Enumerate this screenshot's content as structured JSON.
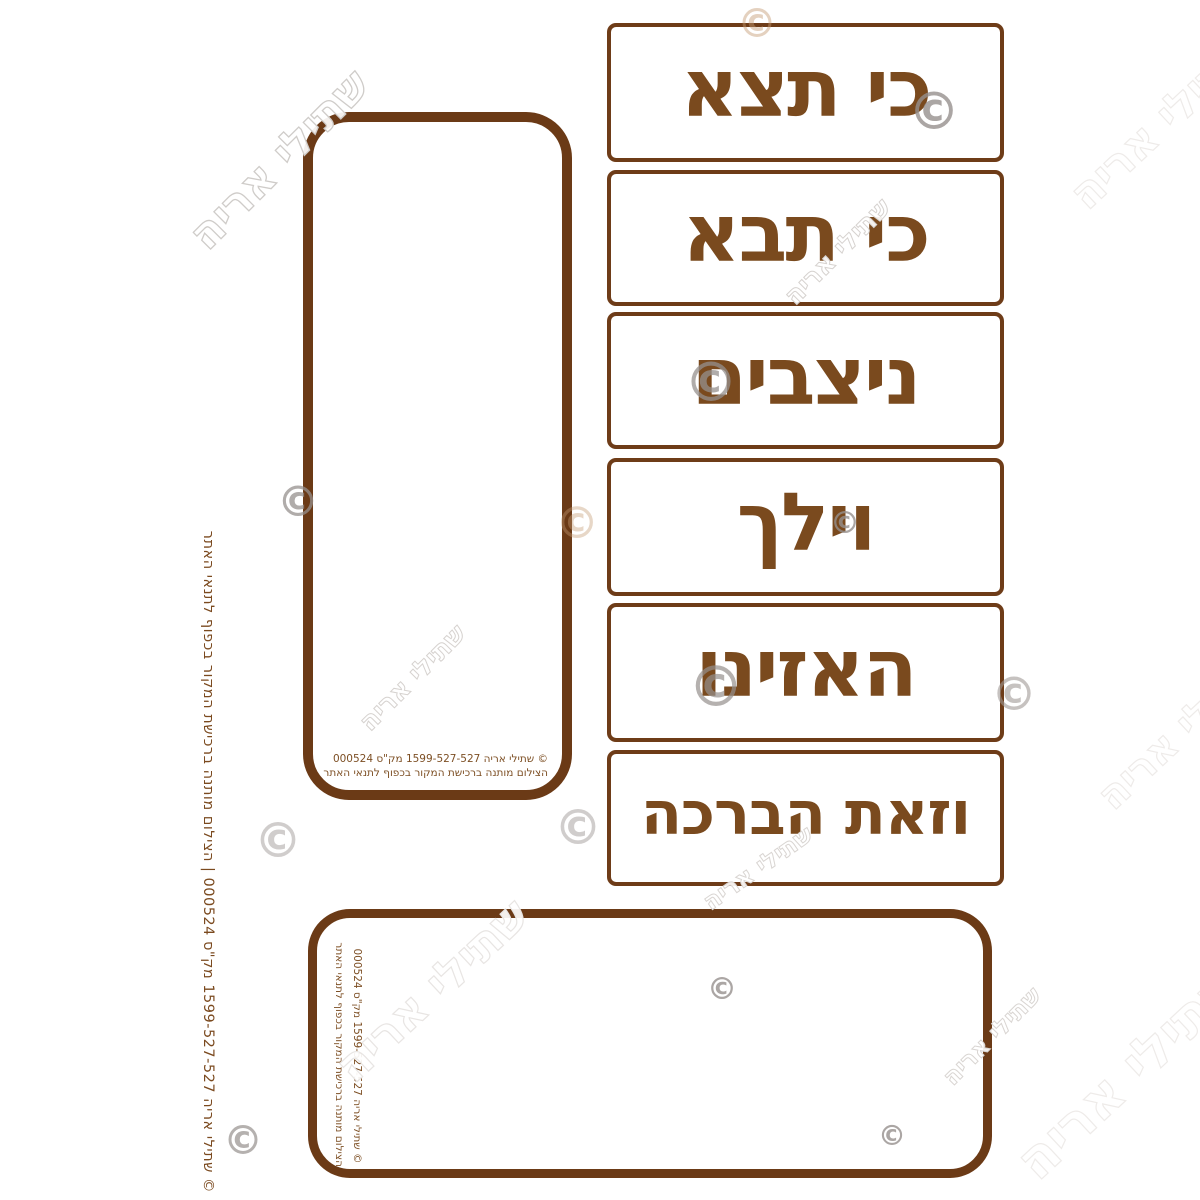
{
  "labels": [
    "כי תצא",
    "כי תבא",
    "ניצבים",
    "וילך",
    "האזינו",
    "וזאת הברכה"
  ],
  "credit": {
    "line1": "© שתילי אריה 1599-527-527 מק\"ס 000524",
    "line2": "הצילום מותנה ברכישת המקור בכפוף לתנאי האתר",
    "side_strip": "© שתילי אריה 1599-527-527 מק\"ס 000524 | הצילום מותנה ברכישת המקור בכפוף לתנאי האתר",
    "phone": "1599-527-527",
    "catalog_number": "000524"
  },
  "watermark": {
    "text": "שתילי אריה",
    "symbol": "©"
  },
  "colors": {
    "label_text_brown": "#7a4a1e",
    "border_brown": "#6b3a16",
    "credit_brown": "#7d4f24",
    "watermark_gray": "#cfccc9",
    "logo_gray": "#96908d"
  }
}
